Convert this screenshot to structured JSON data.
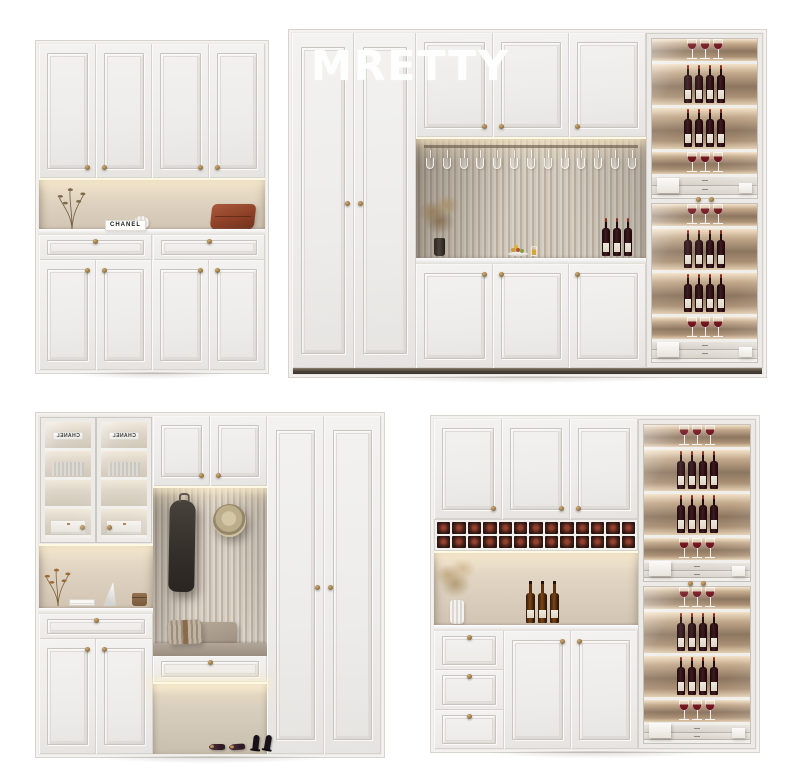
{
  "watermark": {
    "text": "MRETTY"
  },
  "panels": {
    "entry_cabinet": {
      "name": "entryway storage cabinet",
      "sign_text": "CHANEL",
      "upper_doors": 4,
      "drawers": 2,
      "lower_doors": 4
    },
    "wardrobe_wine_wall": {
      "name": "wardrobe with wine display wall",
      "wardrobe_doors": 2,
      "upper_doors": 3,
      "lower_doors": 3,
      "hanging_glasses": 13,
      "niche_bottles": 3,
      "display_columns": 2,
      "shelf_glasses": 3,
      "shelf_bottles": 4,
      "display_drawers": 2
    },
    "mudroom_cabinet": {
      "name": "mudroom hall cabinet with bench",
      "box_label": "CHANEL",
      "glass_doors": 2,
      "upper_doors": 2,
      "drawers": 1,
      "bench_drawers": 1,
      "lower_doors": 2,
      "tall_doors": 2
    },
    "wine_bar_cabinet": {
      "name": "wine bar cabinet",
      "upper_doors": 3,
      "rack_rows": 2,
      "rack_cols": 13,
      "counter_bottles": 3,
      "drawers": 3,
      "lower_doors": 2,
      "display_columns": 2,
      "shelf_glasses": 3,
      "shelf_bottles": 4,
      "display_drawers": 2
    }
  },
  "colors": {
    "background": "#ffffff",
    "cabinet_face": "#f1f0ee",
    "cabinet_trim": "#d4d1cc",
    "warm_niche": "#d9cdbc",
    "led_glow": "#fff3d8",
    "flute_light": "#d2cabf",
    "flute_dark": "#a79c8e",
    "brass_knob": "#9c7b46",
    "wine_bottle_dark": "#241014",
    "wine_red": "#7c1a20",
    "amber_bottle": "#6e3b10",
    "rust_pillow": "#9c4e31",
    "plinth_dark": "#4a4138",
    "watermark_white": "#ffffff"
  }
}
